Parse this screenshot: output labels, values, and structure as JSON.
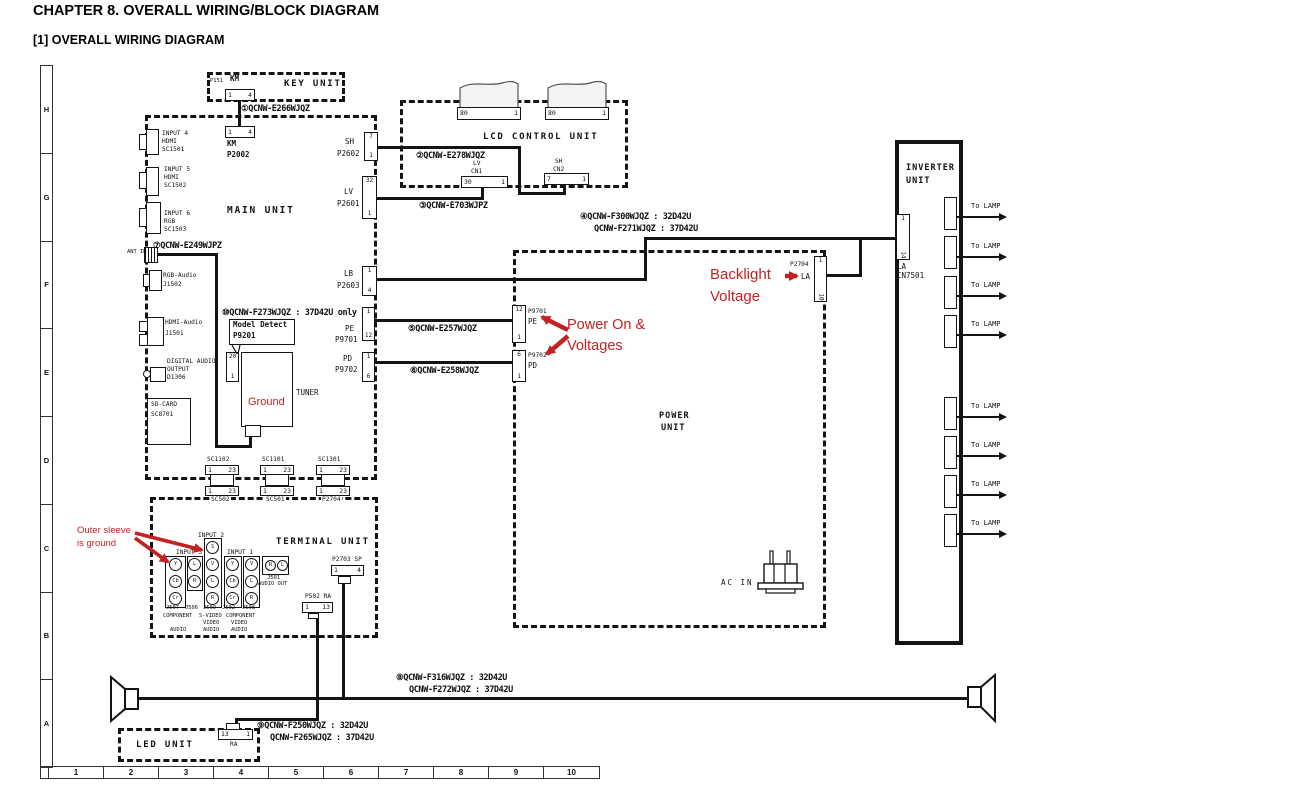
{
  "page": {
    "title": "CHAPTER 8. OVERALL WIRING/BLOCK DIAGRAM",
    "subtitle": "[1] OVERALL WIRING DIAGRAM"
  },
  "colors": {
    "red": "#c32222",
    "line": "#141414"
  },
  "rulers": {
    "rows": [
      "H",
      "G",
      "F",
      "E",
      "D",
      "C",
      "B",
      "A"
    ],
    "cols": [
      "1",
      "2",
      "3",
      "4",
      "5",
      "6",
      "7",
      "8",
      "9",
      "10"
    ]
  },
  "cables": {
    "c1": "①QCNW-E266WJQZ",
    "c2": "②QCNW-E278WJQZ",
    "c3": "③QCNW-E703WJPZ",
    "c4a": "④QCNW-F300WJQZ : 32D42U",
    "c4b": "QCNW-F271WJQZ : 37D42U",
    "c5": "⑤QCNW-E257WJQZ",
    "c6": "⑥QCNW-E258WJQZ",
    "c7": "⑦QCNW-E249WJPZ",
    "c8a": "⑧QCNW-F316WJQZ : 32D42U",
    "c8b": "QCNW-F272WJQZ : 37D42U",
    "c9a": "⑨QCNW-F250WJQZ : 32D42U",
    "c9b": "QCNW-F265WJQZ : 37D42U",
    "c10": "⑩QCNW-F273WJQZ : 37D42U only"
  },
  "key_unit": {
    "name": "KEY UNIT",
    "p151": "P151",
    "km": "KM",
    "pins": {
      "l": "1",
      "r": "4"
    }
  },
  "main_unit": {
    "name": "MAIN UNIT",
    "km": "KM",
    "km_ref": "P2002",
    "km_pins": {
      "l": "1",
      "r": "4"
    },
    "inputs": [
      [
        "INPUT 4",
        "HDMI",
        "SC1501"
      ],
      [
        "INPUT 5",
        "HDMI",
        "SC1502"
      ],
      [
        "INPUT 6",
        "RGB",
        "SC1503"
      ]
    ],
    "ant_in": "ANT IN",
    "rgb_audio": [
      "RGB-Audio",
      "J1502"
    ],
    "hdmi_audio": [
      "HDMI-Audio",
      "J1501"
    ],
    "digital_audio": [
      "DIGITAL AUDIO",
      "OUTPUT",
      "D1306"
    ],
    "sd_card": [
      "SD-CARD",
      "SC8701"
    ],
    "sh": {
      "l": "SH",
      "ref": "P2602",
      "t": "7",
      "b": "1"
    },
    "lv": {
      "l": "LV",
      "ref": "P2601",
      "t": "32",
      "b": "1"
    },
    "lb": {
      "l": "LB",
      "ref": "P2603",
      "t": "1",
      "b": "4"
    },
    "pe": {
      "l": "PE",
      "ref": "P9701",
      "t": "1",
      "b": "12"
    },
    "pd": {
      "l": "PD",
      "ref": "P9702",
      "t": "1",
      "b": "6"
    },
    "model_detect": [
      "Model Detect",
      "P9201"
    ],
    "p9201_pins": {
      "t": "20",
      "b": "1"
    },
    "tuner": "TUNER",
    "ground": "Ground",
    "bc": {
      "t1": "SC1102",
      "t2": "SC1101",
      "t3": "SC1301",
      "b1": "SC502",
      "b2": "SC501",
      "b3": "P2704",
      "pl": "1",
      "pr": "23"
    }
  },
  "lcd_unit": {
    "name": "LCD CONTROL UNIT",
    "flex_pins": {
      "l": "80",
      "r": "1"
    },
    "cn1": {
      "l1": "LV",
      "l2": "CN1",
      "pl": "30",
      "pr": "1"
    },
    "cn2": {
      "l1": "SH",
      "l2": "CN2",
      "pl": "7",
      "pr": "1"
    }
  },
  "power_unit": {
    "name1": "POWER",
    "name2": "UNIT",
    "p9701": {
      "ref": "P9701",
      "l": "PE",
      "t": "12",
      "b": "1"
    },
    "p9702": {
      "ref": "P9702",
      "l": "PD",
      "t": "6",
      "b": "1"
    },
    "p2704": {
      "ref": "P2704",
      "l": "LA",
      "t": "1",
      "b": "10"
    },
    "ac_in": "AC IN"
  },
  "inverter_unit": {
    "name1": "INVERTER",
    "name2": "UNIT",
    "la": "LA",
    "cn7501": "CN7501",
    "pins": {
      "t": "1",
      "b": "14"
    },
    "to_lamp": "To LAMP"
  },
  "terminal_unit": {
    "name": "TERMINAL UNIT",
    "input1": "INPUT 1",
    "input2": "INPUT 2",
    "input3": "INPUT 3",
    "jacks": {
      "comp1": [
        "Y",
        "Cb",
        "Cr"
      ],
      "audio": [
        "L",
        "R"
      ],
      "svideo": [
        "S",
        "V",
        "L",
        "R"
      ],
      "comp2": [
        "Y",
        "Cb",
        "Cr"
      ],
      "av": [
        "V",
        "L",
        "R"
      ],
      "out": [
        "R",
        "L"
      ]
    },
    "j501": "J501",
    "audio_out": "AUDIO OUT",
    "jrefs": [
      "J507",
      "J506",
      "J509",
      "J502",
      "J508"
    ],
    "grp1": [
      "COMPONENT",
      "AUDIO"
    ],
    "grp2": [
      "S-VIDEO",
      "VIDEO",
      "AUDIO"
    ],
    "grp3": [
      "COMPONENT",
      "VIDEO",
      "AUDIO"
    ],
    "p2703": {
      "l": "P2703 SP",
      "pl": "1",
      "pr": "4"
    },
    "p502": {
      "l": "P502 RA",
      "pl": "1",
      "pr": "13"
    }
  },
  "led_unit": {
    "name": "LED UNIT",
    "ra": "RA",
    "pins": {
      "l": "13",
      "r": "1"
    }
  },
  "annotations": {
    "power_on1": "Power On &",
    "power_on2": "Voltages",
    "backlight1": "Backlight",
    "backlight2": "Voltage",
    "sleeve1": "Outer sleeve",
    "sleeve2": "is ground"
  }
}
